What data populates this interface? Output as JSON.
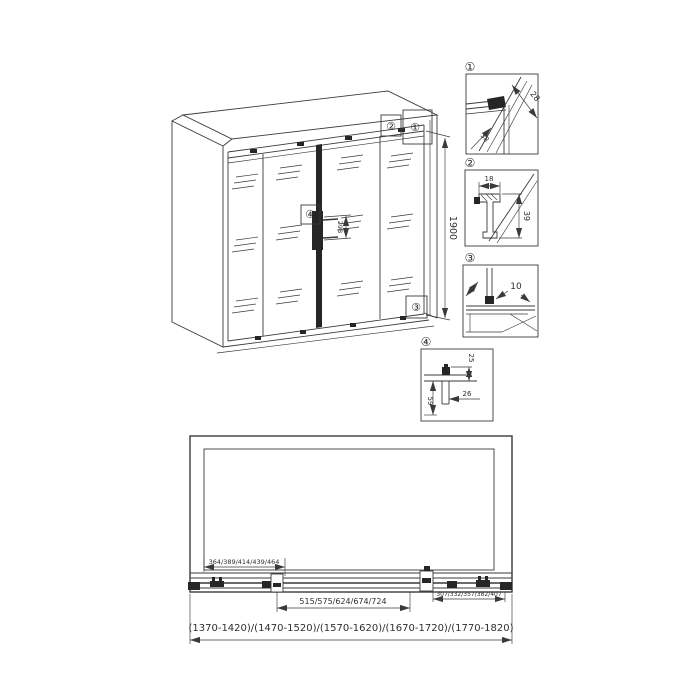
{
  "main_view": {
    "callouts": {
      "c1": "①",
      "c2": "②",
      "c3": "③",
      "c4": "④"
    },
    "dims": {
      "height": "1900",
      "handle": "298"
    }
  },
  "detail_views": [
    {
      "label": "①",
      "dims": {
        "a": "28",
        "b": "38"
      }
    },
    {
      "label": "②",
      "dims": {
        "a": "18",
        "b": "39"
      }
    },
    {
      "label": "③",
      "dims": {
        "a": "10"
      }
    },
    {
      "label": "④",
      "dims": {
        "a": "25",
        "b": "26",
        "c": "59"
      }
    }
  ],
  "elevation_view": {
    "dim_left_panel": "364/389/414/439/464",
    "dim_center_doors": "515/575/624/674/724",
    "dim_right_panel": "307/332/357/382/407",
    "dim_overall": "(1370-1420)/(1470-1520)/(1570-1620)/(1670-1720)/(1770-1820)"
  },
  "colors": {
    "line": "#3a3a3a",
    "dark_fill": "#262626",
    "background": "#ffffff"
  }
}
